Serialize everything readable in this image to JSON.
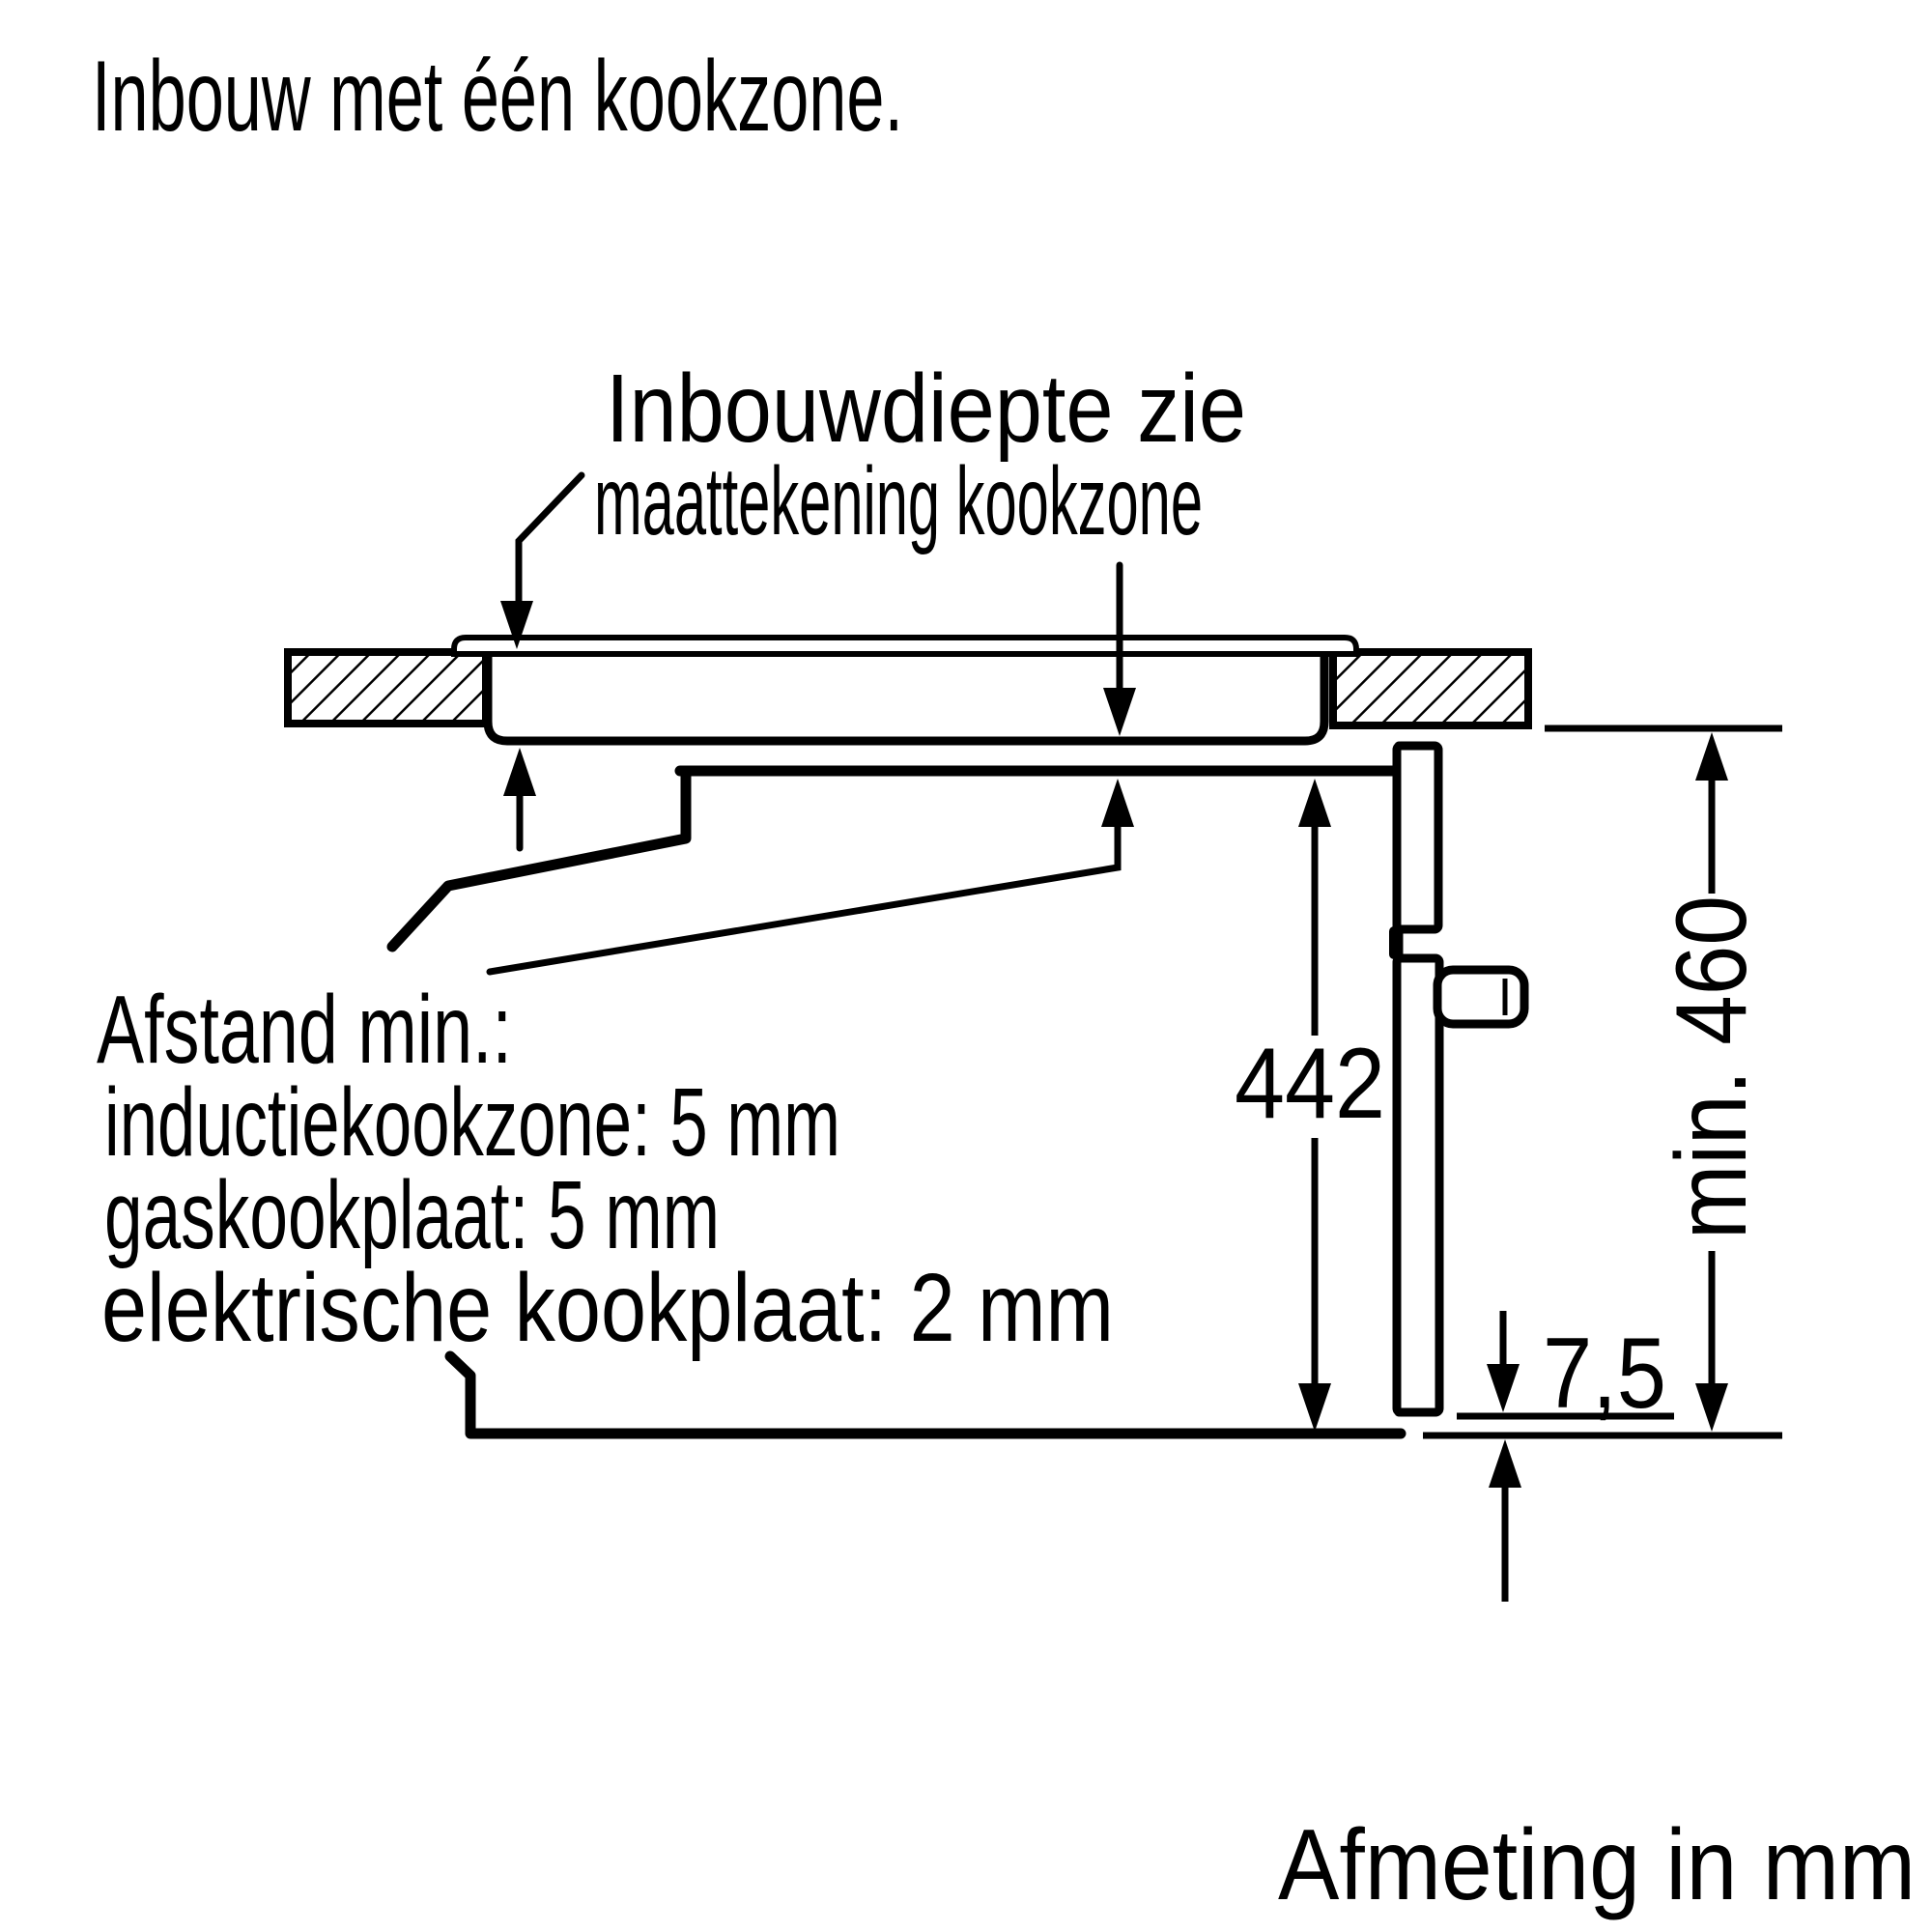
{
  "title": "Inbouw met één kookzone.",
  "footer": "Afmeting in mm",
  "callouts": {
    "depth_note_line1": "Inbouwdiepte zie",
    "depth_note_line2": "maattekening kookzone",
    "clearance_line1": "Afstand min.:",
    "clearance_line2": "inductiekookzone: 5 mm",
    "clearance_line3": "gaskookplaat: 5 mm",
    "clearance_line4": "elektrische kookplaat: 2 mm"
  },
  "dimensions": {
    "oven_height": "442",
    "niche_height": "min. 460",
    "bottom_gap": "7,5"
  },
  "units": "mm",
  "colors": {
    "line": "#000000",
    "background": "#ffffff"
  }
}
